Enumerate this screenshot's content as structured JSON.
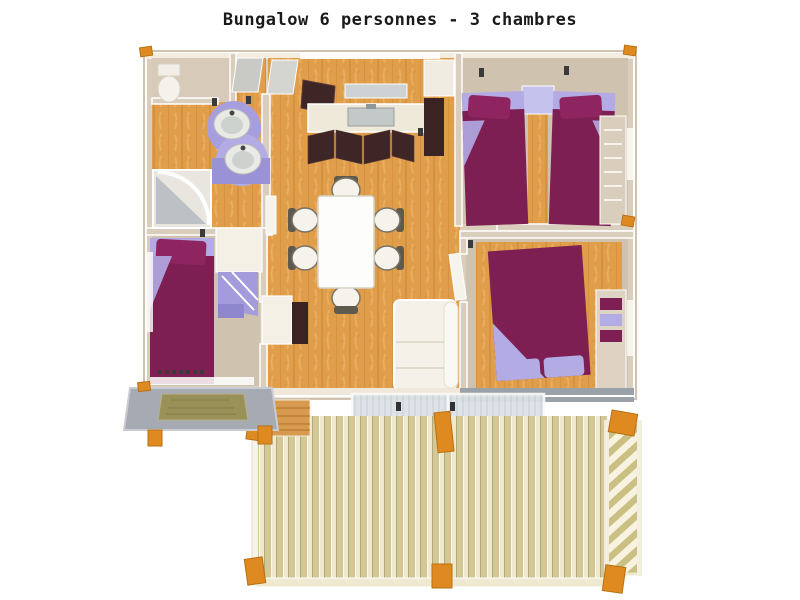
{
  "title": "Bungalow 6 personnes - 3 chambres",
  "palette": {
    "background": "#ffffff",
    "title_color": "#1a1a1a",
    "wall_beige": "#d9cdbb",
    "wall_face_cream": "#f3ecdf",
    "wood_floor": "#e09d4a",
    "wood_grain_line": "#c07f2f",
    "carpet_beige": "#cfc2af",
    "bedding_magenta": "#7d1f53",
    "bedding_magenta_bright": "#8f2560",
    "bedding_lavender": "#b2abe4",
    "vanity_lavender": "#a79fdd",
    "kitchen_cabinet_dark": "#3f2626",
    "counter_cream": "#efe9da",
    "sink_steel": "#c3c9c9",
    "deck_plank_tan": "#d2c795",
    "deck_plank_cream": "#efe9cf",
    "railing_slat_tan": "#cbc084",
    "post_orange": "#df8a20",
    "glass_blue_gray": "#dce2e6",
    "porch_gray": "#a6aab2",
    "doormat_olive": "#9a9159",
    "shadow_wall_gray": "#9aa1a9"
  }
}
